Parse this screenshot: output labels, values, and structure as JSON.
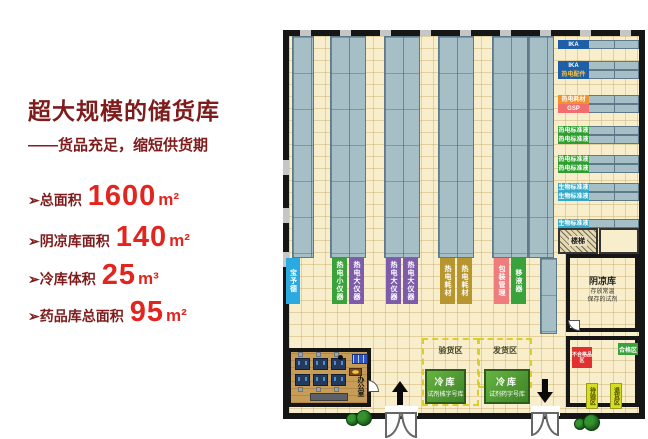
{
  "palette": {
    "accent_red": "#E3251F",
    "title_maroon": "#7E1C1C",
    "wall": "#161616",
    "floor": "#F8EECB",
    "rack": "#A6BFC7",
    "wood": "#C79C57",
    "cold_green": "#4E9E34",
    "zone_dash_yellow": "#D8CE30"
  },
  "left_panel": {
    "title": "超大规模的储货库",
    "subtitle": "——货品充足，缩短供货期",
    "specs": [
      {
        "label": "➢总面积",
        "value": "1600",
        "unit": "m²"
      },
      {
        "label": "➢阴凉库面积",
        "value": "140",
        "unit": "m²"
      },
      {
        "label": "➢冷库体积",
        "value": "25",
        "unit": "m³"
      },
      {
        "label": "➢药品库总面积",
        "value": "95",
        "unit": "m²"
      }
    ]
  },
  "plan": {
    "rack_chips": [
      {
        "text": "宝予德",
        "bg": "#2BA9E1",
        "fg": "#FFFFFF"
      },
      {
        "text": "热电小仪器",
        "bg": "#3AA23A",
        "fg": "#FFFFFF"
      },
      {
        "text": "热电大仪器",
        "bg": "#7D5CAB",
        "fg": "#FFFFFF"
      },
      {
        "text": "热电大仪器",
        "bg": "#7D5CAB",
        "fg": "#FFFFFF"
      },
      {
        "text": "热电大仪器",
        "bg": "#7D5CAB",
        "fg": "#FFFFFF"
      },
      {
        "text": "热电耗材",
        "bg": "#B7952F",
        "fg": "#FFFFFF"
      },
      {
        "text": "热电耗材",
        "bg": "#B7952F",
        "fg": "#FFFFFF"
      },
      {
        "text": "包装管理",
        "bg": "#F07D7D",
        "fg": "#FFFFFF"
      },
      {
        "text": "移液器",
        "bg": "#3AA23A",
        "fg": "#FFFFFF"
      }
    ],
    "right_chips": [
      {
        "text": "IKA",
        "bg": "#1E5FA8",
        "fg": "#FFFFFF"
      },
      {
        "text": "IKA",
        "bg": "#1E5FA8",
        "fg": "#FFFFFF"
      },
      {
        "text": "热电配件",
        "bg": "#1E5FA8",
        "fg": "#F5C242"
      },
      {
        "text": "热电耗材",
        "bg": "#F0922E",
        "fg": "#FFFFFF"
      },
      {
        "text": "GSP",
        "bg": "#F26D6D",
        "fg": "#FFFFFF"
      },
      {
        "text": "热电标准液",
        "bg": "#2F9E2F",
        "fg": "#FFFFFF"
      },
      {
        "text": "热电标准液",
        "bg": "#2F9E2F",
        "fg": "#FFFFFF"
      },
      {
        "text": "热电标准液",
        "bg": "#2F9E2F",
        "fg": "#FFFFFF"
      },
      {
        "text": "热电标准液",
        "bg": "#2F9E2F",
        "fg": "#FFFFFF"
      },
      {
        "text": "生物标准液",
        "bg": "#35A8C8",
        "fg": "#FFFFFF"
      },
      {
        "text": "生物标准液",
        "bg": "#35A8C8",
        "fg": "#FFFFFF"
      },
      {
        "text": "生物标准液",
        "bg": "#35A8C8",
        "fg": "#FFFFFF"
      }
    ],
    "stairs_label": "楼梯",
    "cool_room": {
      "name": "阴凉库",
      "desc_line1": "存放常温",
      "desc_line2": "保存的试剂"
    },
    "zones": {
      "inspection": "验货区",
      "shipping": "发货区"
    },
    "cold_rooms": [
      {
        "name": "冷库",
        "desc": "试剂械字号库"
      },
      {
        "name": "冷库",
        "desc": "试剂药字号库"
      }
    ],
    "office_label": "办公室",
    "qc_room": {
      "reject": {
        "text": "不合格品区",
        "bg": "#E23030",
        "fg": "#FFFFFF"
      },
      "pass": {
        "text": "合格区",
        "bg": "#3AA23A",
        "fg": "#FFFFFF"
      },
      "awaiting": {
        "text": "待验区",
        "bg": "#D6DE23",
        "fg": "#4A4A00"
      },
      "returns": {
        "text": "退货区",
        "bg": "#D6DE23",
        "fg": "#4A4A00"
      }
    }
  }
}
